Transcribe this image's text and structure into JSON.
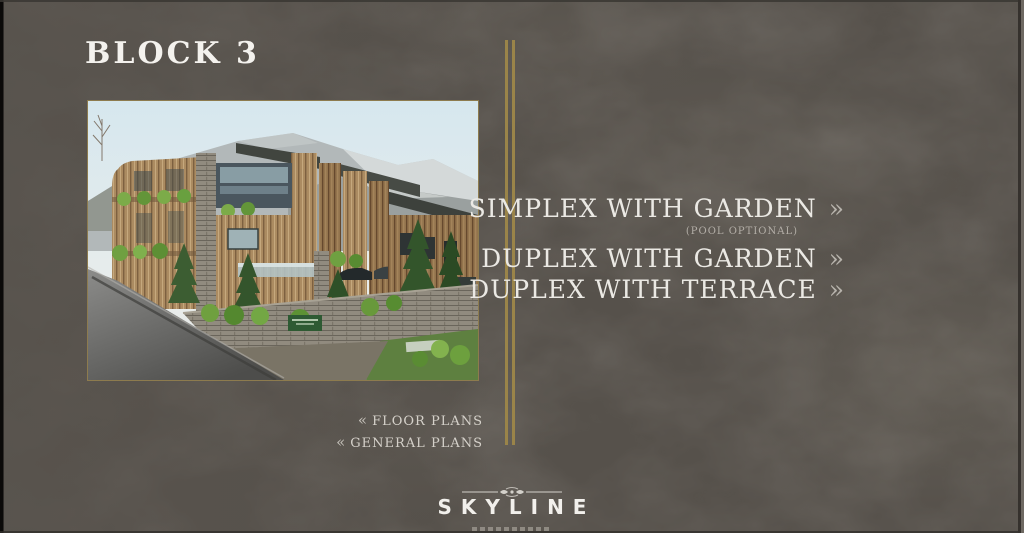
{
  "slide": {
    "title": "BLOCK 3"
  },
  "menu": {
    "chevron_right": "»",
    "items": [
      {
        "label": "SIMPLEX WITH GARDEN",
        "note": "(POOL OPTIONAL)"
      },
      {
        "label": "DUPLEX WITH GARDEN"
      },
      {
        "label": "DUPLEX WITH TERRACE"
      }
    ]
  },
  "nav_links": {
    "chevron_left": "«",
    "items": [
      {
        "label": "FLOOR PLANS"
      },
      {
        "label": "GENERAL PLANS"
      }
    ]
  },
  "footer": {
    "brand": "SKYLINE"
  },
  "image": {
    "description": "architectural rendering of modern wooden residential block on a mountain hillside with road in foreground"
  },
  "colors": {
    "background": "#56514b",
    "accent_gold": "#9a8449",
    "text_light": "#ebe9e4",
    "text_dim": "#b3aea7"
  }
}
